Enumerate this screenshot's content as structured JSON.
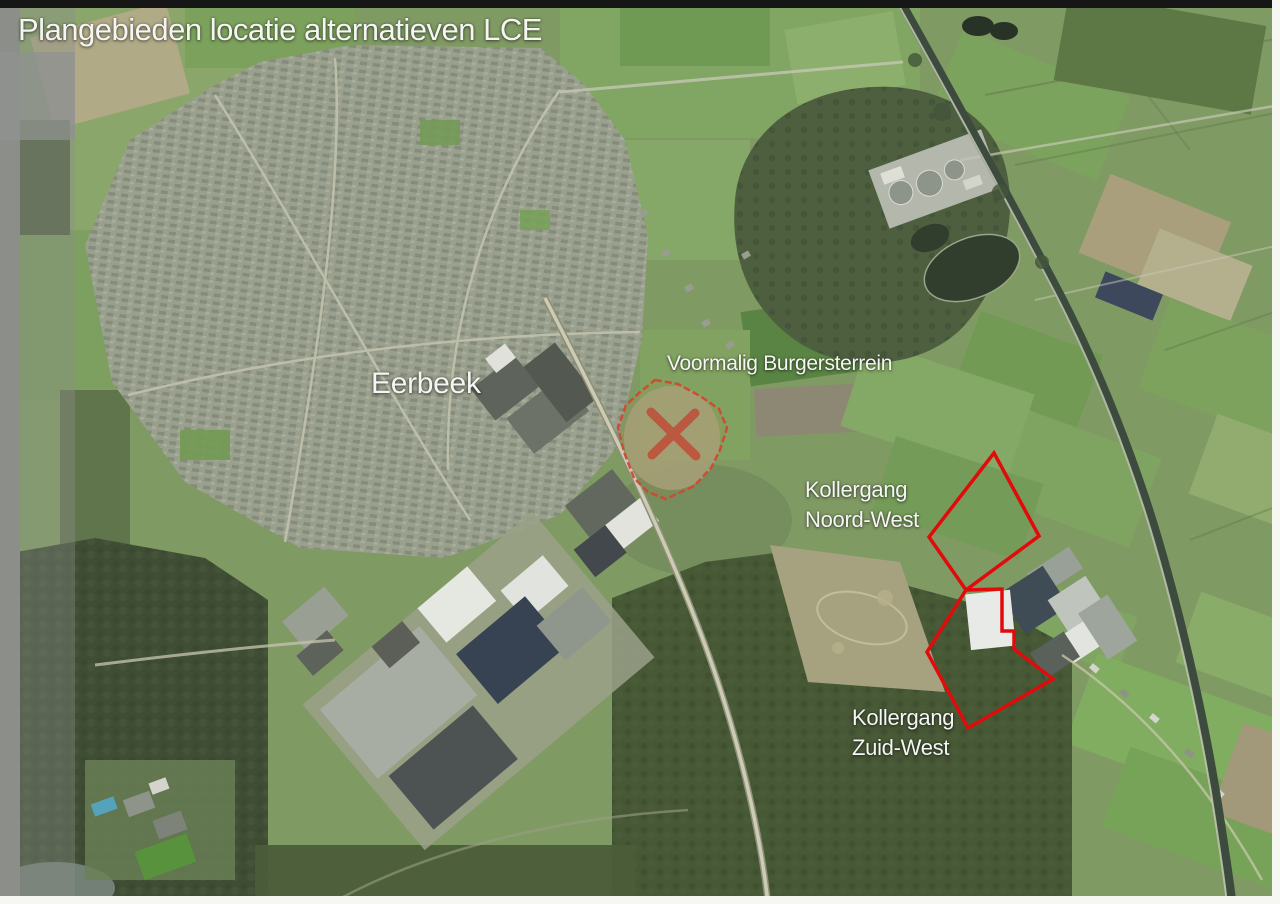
{
  "figure": {
    "title": "Plangebieden locatie alternatieven LCE"
  },
  "map": {
    "town_label": "Eerbeek",
    "sites": {
      "burgersterrein": {
        "label": "Voormalig Burgersterrein"
      },
      "noordwest": {
        "line1": "Kollergang",
        "line2": "Noord-West"
      },
      "zuidwest": {
        "line1": "Kollergang",
        "line2": "Zuid-West"
      }
    },
    "colors": {
      "annotation_red": "#e10b0b",
      "burgersterrein_outline": "#cf4a30",
      "cross_red": "#c53a2b",
      "label_white": "#f5f5f3"
    }
  }
}
